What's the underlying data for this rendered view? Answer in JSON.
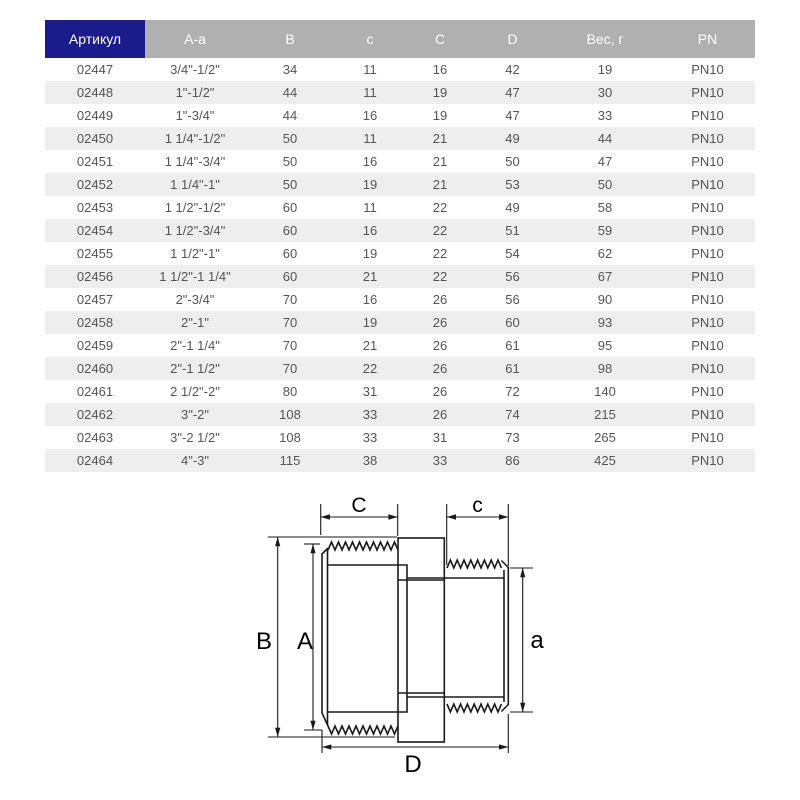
{
  "colors": {
    "article_header_bg": "#1b1b8c",
    "header_bg": "#b0b0b0",
    "header_text": "#ffffff",
    "row_stripe": "#eeeeee",
    "cell_text": "#545454",
    "drawing_line": "#1a1a1a"
  },
  "table": {
    "headers": [
      "Артикул",
      "А-а",
      "В",
      "с",
      "С",
      "D",
      "Вес, г",
      "PN"
    ],
    "rows": [
      [
        "02447",
        "3/4\"-1/2\"",
        "34",
        "11",
        "16",
        "42",
        "19",
        "PN10"
      ],
      [
        "02448",
        "1\"-1/2\"",
        "44",
        "11",
        "19",
        "47",
        "30",
        "PN10"
      ],
      [
        "02449",
        "1\"-3/4\"",
        "44",
        "16",
        "19",
        "47",
        "33",
        "PN10"
      ],
      [
        "02450",
        "1 1/4\"-1/2\"",
        "50",
        "11",
        "21",
        "49",
        "44",
        "PN10"
      ],
      [
        "02451",
        "1 1/4\"-3/4\"",
        "50",
        "16",
        "21",
        "50",
        "47",
        "PN10"
      ],
      [
        "02452",
        "1 1/4\"-1\"",
        "50",
        "19",
        "21",
        "53",
        "50",
        "PN10"
      ],
      [
        "02453",
        "1 1/2\"-1/2\"",
        "60",
        "11",
        "22",
        "49",
        "58",
        "PN10"
      ],
      [
        "02454",
        "1 1/2\"-3/4\"",
        "60",
        "16",
        "22",
        "51",
        "59",
        "PN10"
      ],
      [
        "02455",
        "1 1/2\"-1\"",
        "60",
        "19",
        "22",
        "54",
        "62",
        "PN10"
      ],
      [
        "02456",
        "1 1/2\"-1 1/4\"",
        "60",
        "21",
        "22",
        "56",
        "67",
        "PN10"
      ],
      [
        "02457",
        "2\"-3/4\"",
        "70",
        "16",
        "26",
        "56",
        "90",
        "PN10"
      ],
      [
        "02458",
        "2\"-1\"",
        "70",
        "19",
        "26",
        "60",
        "93",
        "PN10"
      ],
      [
        "02459",
        "2\"-1 1/4\"",
        "70",
        "21",
        "26",
        "61",
        "95",
        "PN10"
      ],
      [
        "02460",
        "2\"-1 1/2\"",
        "70",
        "22",
        "26",
        "61",
        "98",
        "PN10"
      ],
      [
        "02461",
        "2 1/2\"-2\"",
        "80",
        "31",
        "26",
        "72",
        "140",
        "PN10"
      ],
      [
        "02462",
        "3\"-2\"",
        "108",
        "33",
        "26",
        "74",
        "215",
        "PN10"
      ],
      [
        "02463",
        "3\"-2 1/2\"",
        "108",
        "33",
        "31",
        "73",
        "265",
        "PN10"
      ],
      [
        "02464",
        "4\"-3\"",
        "115",
        "38",
        "33",
        "86",
        "425",
        "PN10"
      ]
    ]
  },
  "drawing": {
    "labels": {
      "C": "C",
      "c": "c",
      "B": "B",
      "A": "A",
      "a": "a",
      "D": "D"
    }
  }
}
